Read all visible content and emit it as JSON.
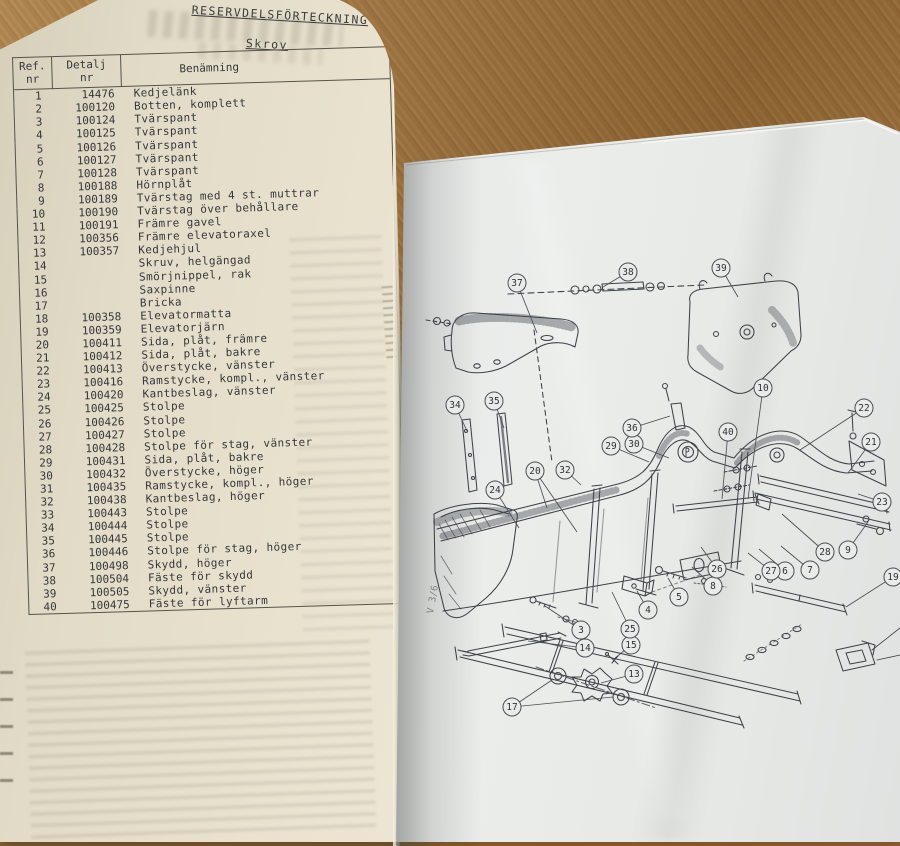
{
  "book": {
    "left_page": {
      "title": "RESERVDELSFÖRTECKNING",
      "section": "Skrov",
      "table": {
        "headers": {
          "ref": [
            "Ref.",
            "nr"
          ],
          "detalj": [
            "Detalj",
            "nr"
          ],
          "benamning": "Benämning"
        },
        "rows": [
          [
            "1",
            "14476",
            "Kedjelänk"
          ],
          [
            "2",
            "100120",
            "Botten, komplett"
          ],
          [
            "3",
            "100124",
            "Tvärspant"
          ],
          [
            "4",
            "100125",
            "Tvärspant"
          ],
          [
            "5",
            "100126",
            "Tvärspant"
          ],
          [
            "6",
            "100127",
            "Tvärspant"
          ],
          [
            "7",
            "100128",
            "Tvärspant"
          ],
          [
            "8",
            "100188",
            "Hörnplåt"
          ],
          [
            "9",
            "100189",
            "Tvärstag med 4 st. muttrar"
          ],
          [
            "10",
            "100190",
            "Tvärstag över behållare"
          ],
          [
            "11",
            "100191",
            "Främre gavel"
          ],
          [
            "12",
            "100356",
            "Främre elevatoraxel"
          ],
          [
            "13",
            "100357",
            "Kedjehjul"
          ],
          [
            "14",
            "",
            "Skruv, helgängad"
          ],
          [
            "15",
            "",
            "Smörjnippel, rak"
          ],
          [
            "16",
            "",
            "Saxpinne"
          ],
          [
            "17",
            "",
            "Bricka"
          ],
          [
            "18",
            "100358",
            "Elevatormatta"
          ],
          [
            "19",
            "100359",
            "Elevatorjärn"
          ],
          [
            "20",
            "100411",
            "Sida, plåt, främre"
          ],
          [
            "21",
            "100412",
            "Sida, plåt, bakre"
          ],
          [
            "22",
            "100413",
            "Överstycke, vänster"
          ],
          [
            "23",
            "100416",
            "Ramstycke, kompl., vänster"
          ],
          [
            "24",
            "100420",
            "Kantbeslag, vänster"
          ],
          [
            "25",
            "100425",
            "Stolpe"
          ],
          [
            "26",
            "100426",
            "Stolpe"
          ],
          [
            "27",
            "100427",
            "Stolpe"
          ],
          [
            "28",
            "100428",
            "Stolpe för stag, vänster"
          ],
          [
            "29",
            "100431",
            "Sida, plåt, bakre"
          ],
          [
            "30",
            "100432",
            "Överstycke, höger"
          ],
          [
            "31",
            "100435",
            "Ramstycke, kompl., höger"
          ],
          [
            "32",
            "100438",
            "Kantbeslag, höger"
          ],
          [
            "33",
            "100443",
            "Stolpe"
          ],
          [
            "34",
            "100444",
            "Stolpe"
          ],
          [
            "35",
            "100445",
            "Stolpe"
          ],
          [
            "36",
            "100446",
            "Stolpe för stag, höger"
          ],
          [
            "37",
            "100498",
            "Skydd, höger"
          ],
          [
            "38",
            "100504",
            "Fäste för skydd"
          ],
          [
            "39",
            "100505",
            "Skydd, vänster"
          ],
          [
            "40",
            "100475",
            "Fäste för lyftarm"
          ]
        ]
      }
    },
    "right_page": {
      "edge_label": "V 3/6",
      "callouts": [
        {
          "n": "3",
          "x": 581,
          "y": 630,
          "tx": 545,
          "ty": 606
        },
        {
          "n": "4",
          "x": 648,
          "y": 610,
          "tx": 637,
          "ty": 591
        },
        {
          "n": "5",
          "x": 679,
          "y": 597,
          "tx": 668,
          "ty": 578
        },
        {
          "n": "6",
          "x": 785,
          "y": 571,
          "tx": 759,
          "ty": 549
        },
        {
          "n": "7",
          "x": 810,
          "y": 570,
          "tx": 781,
          "ty": 546
        },
        {
          "n": "8",
          "x": 713,
          "y": 586,
          "tx": 692,
          "ty": 567
        },
        {
          "n": "9",
          "x": 848,
          "y": 550,
          "tx": 868,
          "ty": 522
        },
        {
          "n": "10",
          "x": 763,
          "y": 388,
          "tx": 748,
          "ty": 499
        },
        {
          "n": "13",
          "x": 634,
          "y": 674,
          "tx": 601,
          "ty": 683
        },
        {
          "n": "14",
          "x": 585,
          "y": 648,
          "tx": 528,
          "ty": 641
        },
        {
          "n": "15",
          "x": 631,
          "y": 645,
          "tx": 614,
          "ty": 659
        },
        {
          "n": "17",
          "x": 512,
          "y": 707,
          "tx": 552,
          "ty": 680,
          "tx2": 613,
          "ty2": 697
        },
        {
          "n": "19",
          "x": 893,
          "y": 577,
          "tx": 846,
          "ty": 607
        },
        {
          "n": "20",
          "x": 535,
          "y": 471,
          "tx": 547,
          "ty": 508,
          "tx2": 577,
          "ty2": 532
        },
        {
          "n": "21",
          "x": 871,
          "y": 442,
          "tx": 848,
          "ty": 473
        },
        {
          "n": "22",
          "x": 864,
          "y": 408,
          "tx": 800,
          "ty": 450
        },
        {
          "n": "23",
          "x": 882,
          "y": 502,
          "tx": 858,
          "ty": 494
        },
        {
          "n": "24",
          "x": 495,
          "y": 490,
          "tx": 519,
          "ty": 528
        },
        {
          "n": "25",
          "x": 630,
          "y": 629,
          "tx": 612,
          "ty": 592
        },
        {
          "n": "26",
          "x": 717,
          "y": 569,
          "tx": 701,
          "ty": 547
        },
        {
          "n": "27",
          "x": 771,
          "y": 571,
          "tx": 748,
          "ty": 553
        },
        {
          "n": "28",
          "x": 825,
          "y": 552,
          "tx": 782,
          "ty": 514
        },
        {
          "n": "29",
          "x": 611,
          "y": 446,
          "tx": 649,
          "ty": 462
        },
        {
          "n": "30",
          "x": 634,
          "y": 444,
          "tx": 669,
          "ty": 458
        },
        {
          "n": "32",
          "x": 565,
          "y": 470,
          "tx": 581,
          "ty": 485
        },
        {
          "n": "34",
          "x": 455,
          "y": 405,
          "tx": 467,
          "ty": 431
        },
        {
          "n": "35",
          "x": 494,
          "y": 401,
          "tx": 504,
          "ty": 428
        },
        {
          "n": "36",
          "x": 632,
          "y": 428,
          "tx": 670,
          "ty": 416
        },
        {
          "n": "37",
          "x": 517,
          "y": 283,
          "tx": 537,
          "ty": 333
        },
        {
          "n": "38",
          "x": 628,
          "y": 272,
          "tx": 603,
          "ty": 287
        },
        {
          "n": "39",
          "x": 721,
          "y": 268,
          "tx": 738,
          "ty": 297
        },
        {
          "n": "40",
          "x": 728,
          "y": 432,
          "tx": 722,
          "ty": 499
        }
      ]
    }
  },
  "colors": {
    "wood": "#9c713c",
    "page_left": "#eae3d0",
    "page_right": "#e7eae9",
    "ink": "#35373b",
    "diagram_ink": "#3d4248"
  }
}
